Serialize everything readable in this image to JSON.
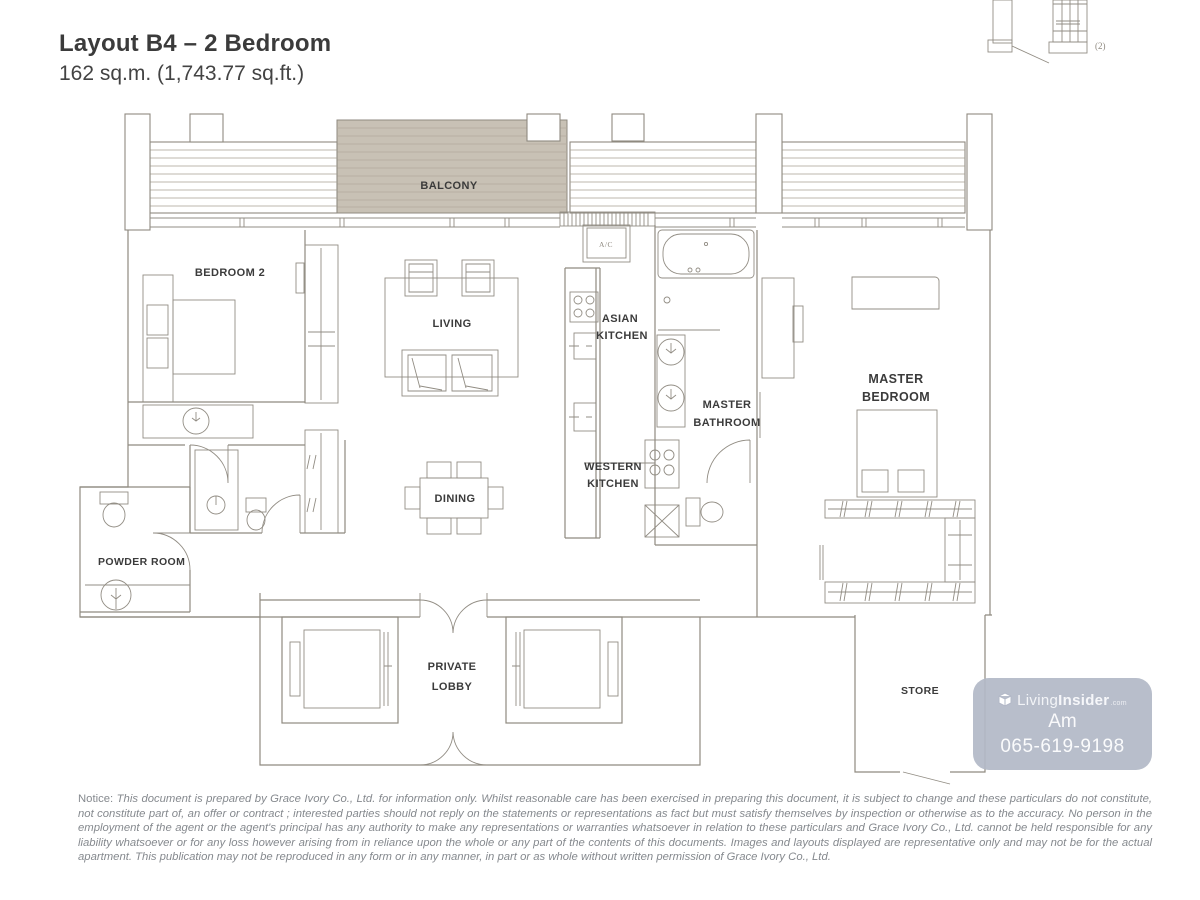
{
  "header": {
    "title": "Layout B4 – 2 Bedroom",
    "subtitle": "162 sq.m. (1,743.77 sq.ft.)"
  },
  "keyplan": {
    "note": "(2)"
  },
  "rooms": {
    "balcony": "BALCONY",
    "bedroom2": "BEDROOM 2",
    "living": "LIVING",
    "dining": "DINING",
    "ac": "A/C",
    "asian_kitchen": [
      "ASIAN",
      "KITCHEN"
    ],
    "western_kitchen": [
      "WESTERN",
      "KITCHEN"
    ],
    "master_bathroom": [
      "MASTER",
      "BATHROOM"
    ],
    "master_bedroom": [
      "MASTER",
      "BEDROOM"
    ],
    "powder_room": "POWDER ROOM",
    "private_lobby": [
      "PRIVATE",
      "LOBBY"
    ],
    "store": "STORE"
  },
  "watermark": {
    "brand_prefix": "Living",
    "brand_suffix": "Insider",
    "brand_tld": ".com",
    "line2": "Am",
    "line3": "065-619-9198"
  },
  "notice": {
    "prefix": "Notice:",
    "body": "This document is prepared by Grace Ivory Co., Ltd. for information only. Whilst reasonable care has been exercised in preparing this document, it is subject to change and these particulars do not constitute, not constitute part of, an offer or contract ; interested parties should not reply on the statements or representations as fact but must satisfy themselves by inspection or otherwise as to the accuracy. No person in the employment of the agent or the agent's principal has any authority to make any representations or warranties whatsoever in relation to these particulars and Grace Ivory Co., Ltd.  cannot be held responsible for any liability whatsoever or for any loss however arising from in reliance upon the whole or any part of the contents of this documents. Images and layouts displayed are representative only and may not be for the actual apartment. This publication may not be reproduced in any form or in any manner,  in part or as whole without written permission of Grace Ivory Co., Ltd."
  },
  "colors": {
    "wall_line": "#8f8a80",
    "balcony_fill": "#c8c1b5",
    "label_text": "#3b3b3b",
    "watermark_bg": "#b2b8c7",
    "notice_text": "#85898e"
  }
}
